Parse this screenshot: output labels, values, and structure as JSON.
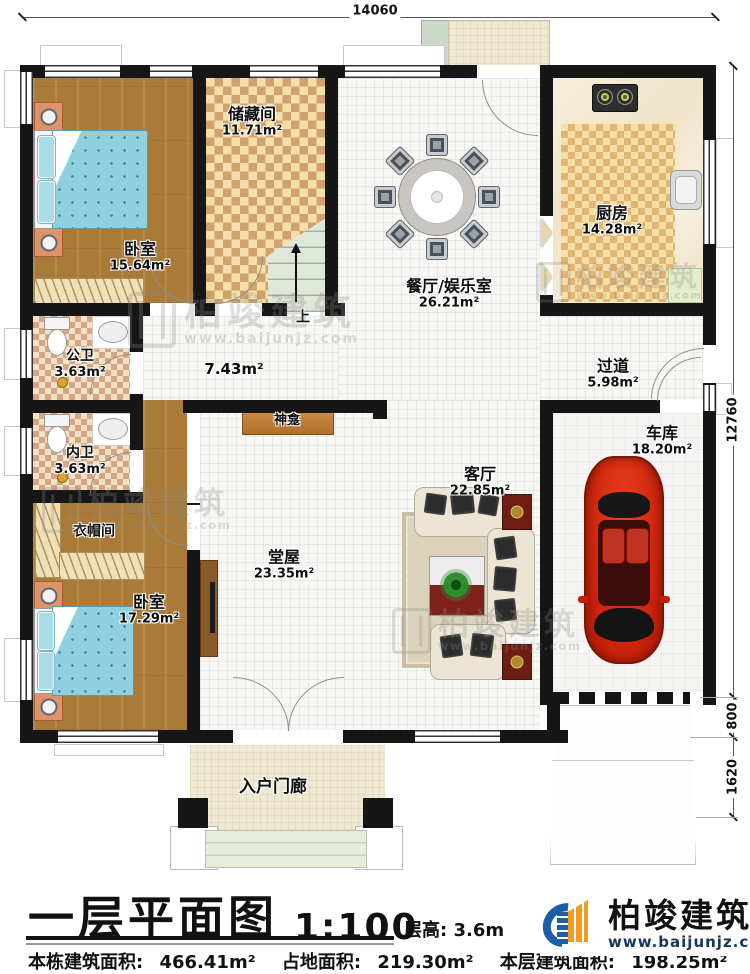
{
  "dimensions": {
    "top": "14060",
    "right_total": "12760",
    "right_800": "800",
    "right_1620": "1620"
  },
  "rooms": {
    "bedroom1": {
      "label": "卧室",
      "area": "15.64m²"
    },
    "storage": {
      "label": "储藏间",
      "area": "11.71m²"
    },
    "dining": {
      "label": "餐厅/娱乐室",
      "area": "26.21m²"
    },
    "kitchen": {
      "label": "厨房",
      "area": "14.28m²"
    },
    "corridor": {
      "area": "7.43m²"
    },
    "hallway": {
      "label": "过道",
      "area": "5.98m²"
    },
    "bath_public": {
      "label": "公卫",
      "area": "3.63m²"
    },
    "bath_private": {
      "label": "内卫",
      "area": "3.63m²"
    },
    "cloakroom": {
      "label": "衣帽间"
    },
    "bedroom2": {
      "label": "卧室",
      "area": "17.29m²"
    },
    "main_hall": {
      "label": "堂屋",
      "area": "23.35m²"
    },
    "living": {
      "label": "客厅",
      "area": "22.85m²"
    },
    "garage": {
      "label": "车库",
      "area": "18.20m²"
    },
    "shrine": {
      "label": "神龛"
    },
    "porch": {
      "label": "入户门廊"
    },
    "stairs": {
      "label": "上"
    }
  },
  "title_block": {
    "plan_name": "一层平面图",
    "scale": "1:100",
    "floor_height_label": "层高:",
    "floor_height_value": "3.6m",
    "stats": [
      {
        "label": "本栋建筑面积:",
        "value": "466.41m²"
      },
      {
        "label": "占地面积:",
        "value": "219.30m²"
      },
      {
        "label": "本层建筑面积:",
        "value": "198.25m²"
      }
    ]
  },
  "branding": {
    "company": "柏竣建筑",
    "website": "www.baijunjz.com"
  },
  "watermark": {
    "text": "柏竣建筑",
    "website": "www.baijunjz.com"
  },
  "colors": {
    "wall": "#161616",
    "wood_floor": "#aa7a38",
    "checker_dark": "#d0a36e",
    "tile": "#f7f7f4",
    "bed": "#8fd0de",
    "car_red": "#d92c12",
    "logo_blue": "#1a5fa8",
    "logo_orange": "#f29b1d"
  }
}
